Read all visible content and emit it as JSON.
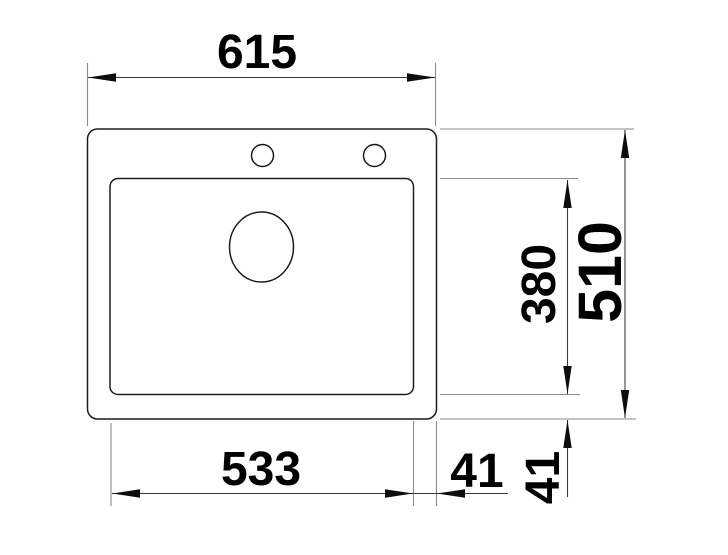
{
  "drawing": {
    "kind": "technical-dimension-drawing",
    "subject": "inset sink top view: outer rim, single bowl, drain hole, two tap holes",
    "colors": {
      "background": "#ffffff",
      "object_lines": "#1d1d1d",
      "extension_lines": "#8a8a8a",
      "dimension_lines": "#3c3c3c",
      "text": "#000000"
    },
    "dims": {
      "overall_width": "615",
      "overall_depth": "510",
      "bowl_width": "533",
      "bowl_depth": "380",
      "right_offset": "41",
      "bottom_offset": "41"
    }
  }
}
